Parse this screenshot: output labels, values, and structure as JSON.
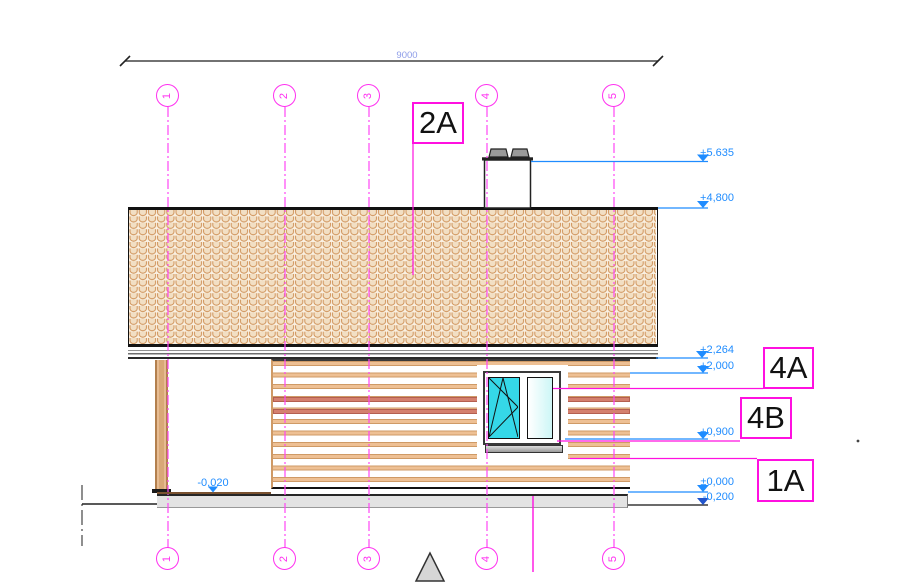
{
  "dimension": {
    "length_label": "9000"
  },
  "axes": [
    {
      "label": "1"
    },
    {
      "label": "2"
    },
    {
      "label": "3"
    },
    {
      "label": "4"
    },
    {
      "label": "5"
    }
  ],
  "levels": {
    "chimney_top": "+5.635",
    "ridge": "+4,800",
    "eaves": "+2,264",
    "wall_top": "+2,000",
    "sill": "+0,900",
    "floor": "±0,000",
    "ground": "-0,200",
    "porch_floor": "-0,020"
  },
  "callouts": {
    "roof": "2A",
    "facade_upper": "4A",
    "facade_lower": "4B",
    "plinth": "1A"
  }
}
